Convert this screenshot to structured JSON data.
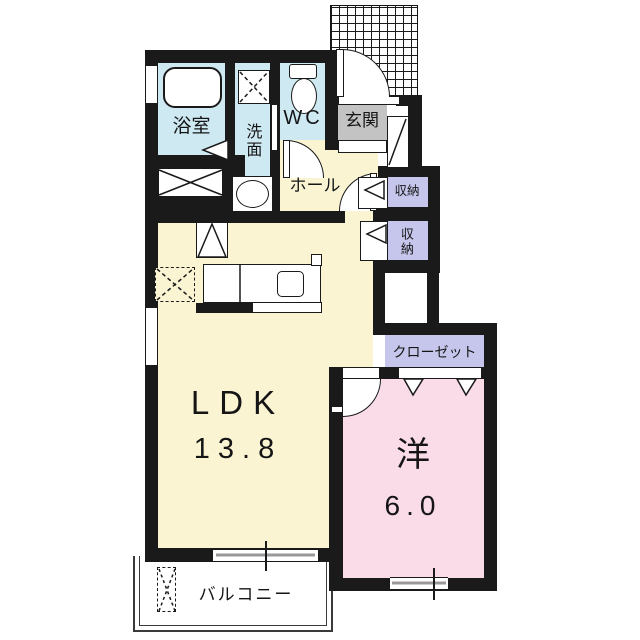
{
  "rooms": {
    "bathroom": {
      "label": "浴室"
    },
    "washroom": {
      "label": "洗面"
    },
    "wc": {
      "label": "WC"
    },
    "entrance": {
      "label": "玄関"
    },
    "hall": {
      "label": "ホール"
    },
    "storage_1": {
      "label": "収納"
    },
    "storage_2": {
      "label": "収納"
    },
    "closet": {
      "label": "クローゼット"
    },
    "ldk": {
      "label": "LDK",
      "area": "13.8"
    },
    "western_room": {
      "label": "洋",
      "area": "6.0"
    },
    "balcony": {
      "label": "バルコニー"
    }
  },
  "colors": {
    "wall": "#1a1a1a",
    "wet_rooms": "#cfe9f3",
    "living": "#faf4d3",
    "bedroom": "#fadce8",
    "storage": "#c6c6ec",
    "entrance_floor": "#c3c3c3"
  }
}
